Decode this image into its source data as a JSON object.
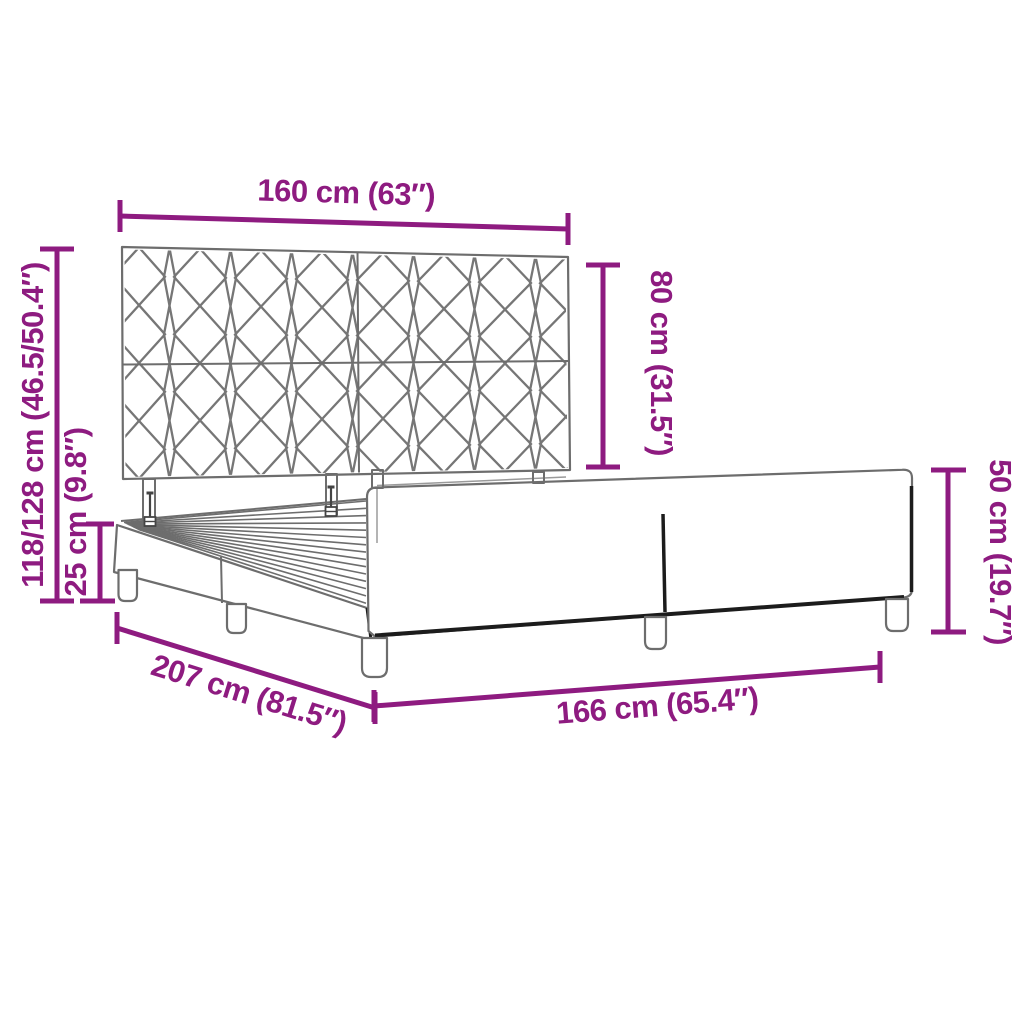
{
  "diagram": {
    "accent_color": "#8E1B80",
    "sketch_color": "#6d6d6d",
    "subject": "bed-frame-with-headboard",
    "dimensions": {
      "headboard_width": "160 cm (63″)",
      "headboard_height": "80 cm (31.5″)",
      "overall_height": "118/128 cm (46.5/50.4″)",
      "base_height": "25 cm (9.8″)",
      "frame_length": "207 cm (81.5″)",
      "frame_width": "166 cm (65.4″)",
      "side_panel_height": "50 cm (19.7″)"
    }
  }
}
